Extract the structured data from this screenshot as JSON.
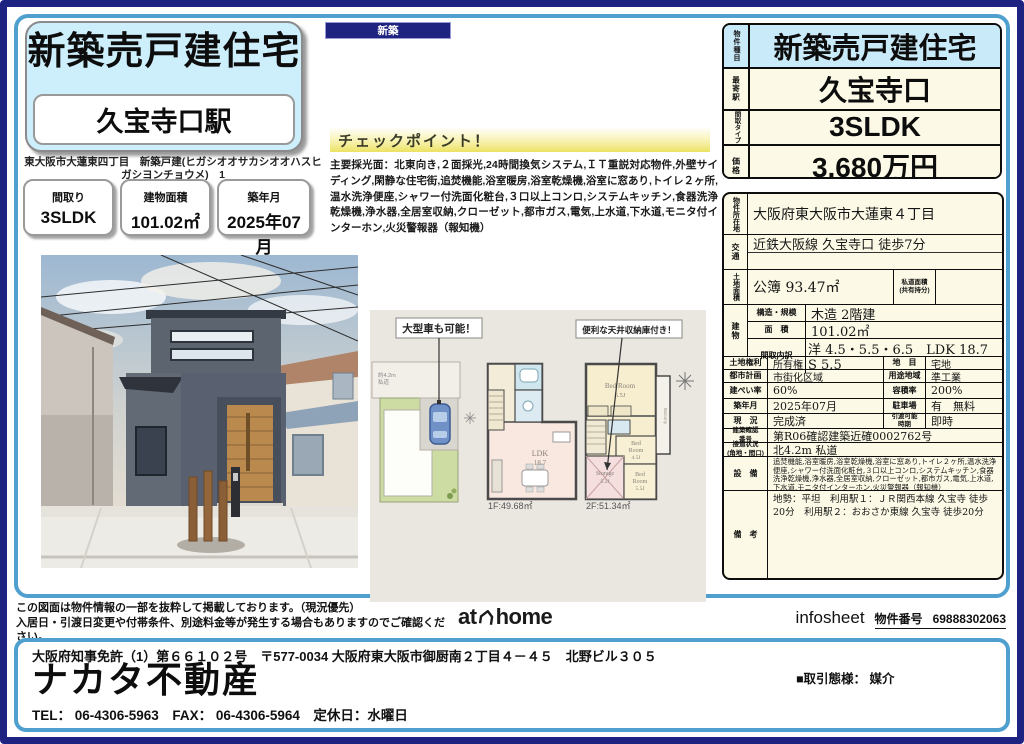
{
  "badge": {
    "label": "新築"
  },
  "header": {
    "title": "新築売戸建住宅",
    "station": "久宝寺口駅",
    "address": "東大阪市大蓮東四丁目　新築戸建(ヒガシオオサカシオオハスヒガシヨンチョウメ)　1",
    "info_boxes": [
      {
        "label": "間取り",
        "value": "3SLDK"
      },
      {
        "label": "建物面積",
        "value": "101.02㎡"
      },
      {
        "label": "築年月",
        "value": "2025年07月"
      }
    ]
  },
  "checkpoint": {
    "title": "チェックポイント！",
    "body": "主要採光面：北東向き,２面採光,24時間換気システム,ＩＴ重説対応物件,外壁サイディング,閑静な住宅街,追焚機能,浴室暖房,浴室乾燥機,浴室に窓あり,トイレ２ヶ所,温水洗浄便座,シャワー付洗面化粧台,３口以上コンロ,システムキッチン,食器洗浄乾燥機,浄水器,全居室収納,クローゼット,都市ガス,電気,上水道,下水道,モニタ付インターホン,火災警報器（報知機）"
  },
  "summary": {
    "rows": [
      {
        "label": "物件種目",
        "value": "新築売戸建住宅"
      },
      {
        "label": "最寄駅",
        "value": "久宝寺口"
      },
      {
        "label": "間取タイプ",
        "value": "3SLDK"
      },
      {
        "label": "価格",
        "value": "3,680万円"
      }
    ]
  },
  "detail": {
    "location_label": "物件所在地",
    "location": "大阪府東大阪市大蓮東４丁目",
    "transport_label": "交通",
    "transport": "近鉄大阪線 久宝寺口 徒歩7分",
    "land_label": "土地面積",
    "land": "公簿 93.47㎡",
    "private_road_label_1": "私道面積",
    "private_road_label_2": "(共有持分)",
    "private_road": "",
    "building_label": "建物",
    "structure_label": "構造・規模",
    "structure": "木造 2階建",
    "barea_label": "面　積",
    "barea": "101.02㎡",
    "layout_label": "間取内訳",
    "layout": "洋 4.5・5.5・6.5　LDK 18.7　S 5.5",
    "land_right_label": "土地権利",
    "land_right": "所有権",
    "chimoku_label": "地　目",
    "chimoku": "宅地",
    "city_label": "都市計画",
    "city": "市街化区域",
    "zone_label": "用途地域",
    "zone": "準工業",
    "coverage_label": "建ぺい率",
    "coverage": "60%",
    "volume_label": "容積率",
    "volume": "200%",
    "built_label": "築年月",
    "built": "2025年07月",
    "parking_label": "駐車場",
    "parking": "有　無料",
    "status_label": "現　況",
    "status": "完成済",
    "delivery_label_1": "引渡可能",
    "delivery_label_2": "時期",
    "delivery": "即時",
    "confirm_label_1": "建築確認",
    "confirm_label_2": "番号",
    "confirm": "第R06確認建築近確0002762号",
    "road_label_1": "接道状況",
    "road_label_2": "(角地・間口)",
    "road": "北4.2m 私道",
    "equip_label": "設　備",
    "equip": "追焚機能,浴室暖房,浴室乾燥機,浴室に窓あり,トイレ２ヶ所,温水洗浄便座,シャワー付洗面化粧台,３口以上コンロ,システムキッチン,食器洗浄乾燥機,浄水器,全居室収納,クローゼット,都市ガス,電気,上水道,下水道,モニタ付インターホン,火災警報器（報知機）",
    "remarks_label": "備　考",
    "remarks": "地勢：平坦　利用駅１：ＪＲ関西本線 久宝寺 徒歩20分　利用駅２：おおさか東線 久宝寺 徒歩20分"
  },
  "floorplan": {
    "callout_car": "大型車も可能！",
    "callout_attic": "便利な天井収納庫付き！",
    "road_label_1": "約4.2m",
    "road_label_2": "私道",
    "f1_area": "1F:49.68㎡",
    "f2_area": "2F:51.34㎡",
    "ldk_1": "LDK",
    "ldk_2": "18.7",
    "bed1_1": "Bed Room",
    "bed1_2": "6.5J",
    "bed2_1": "Bed",
    "bed2_2": "Room",
    "bed2_3": "4.5J",
    "bed3_1": "Bed",
    "bed3_2": "Room",
    "bed3_3": "5.5J",
    "storage_1": "Storage",
    "storage_2": "5.2J",
    "balcony": "Balcony",
    "dn": "DN"
  },
  "strip": {
    "note_1": "この図面は物件情報の一部を抜粋して掲載しております。（現況優先）",
    "note_2": "入居日・引渡日変更や付帯条件、別途料金等が発生する場合もありますのでご確認ください。",
    "athome_at": "at",
    "athome_home": "home",
    "infosheet": "infosheet",
    "property_no_label": "物件番号",
    "property_no": "69888302063"
  },
  "company": {
    "license": "大阪府知事免許（1）第６６１０２号　〒577-0034 大阪府東大阪市御厨南２丁目４－４５　北野ビル３０５",
    "name": "ナカタ不動産",
    "contact": "TEL： 06-4306-5963　FAX： 06-4306-5964　定休日：水曜日",
    "deal_type": "■取引態様： 媒介"
  }
}
